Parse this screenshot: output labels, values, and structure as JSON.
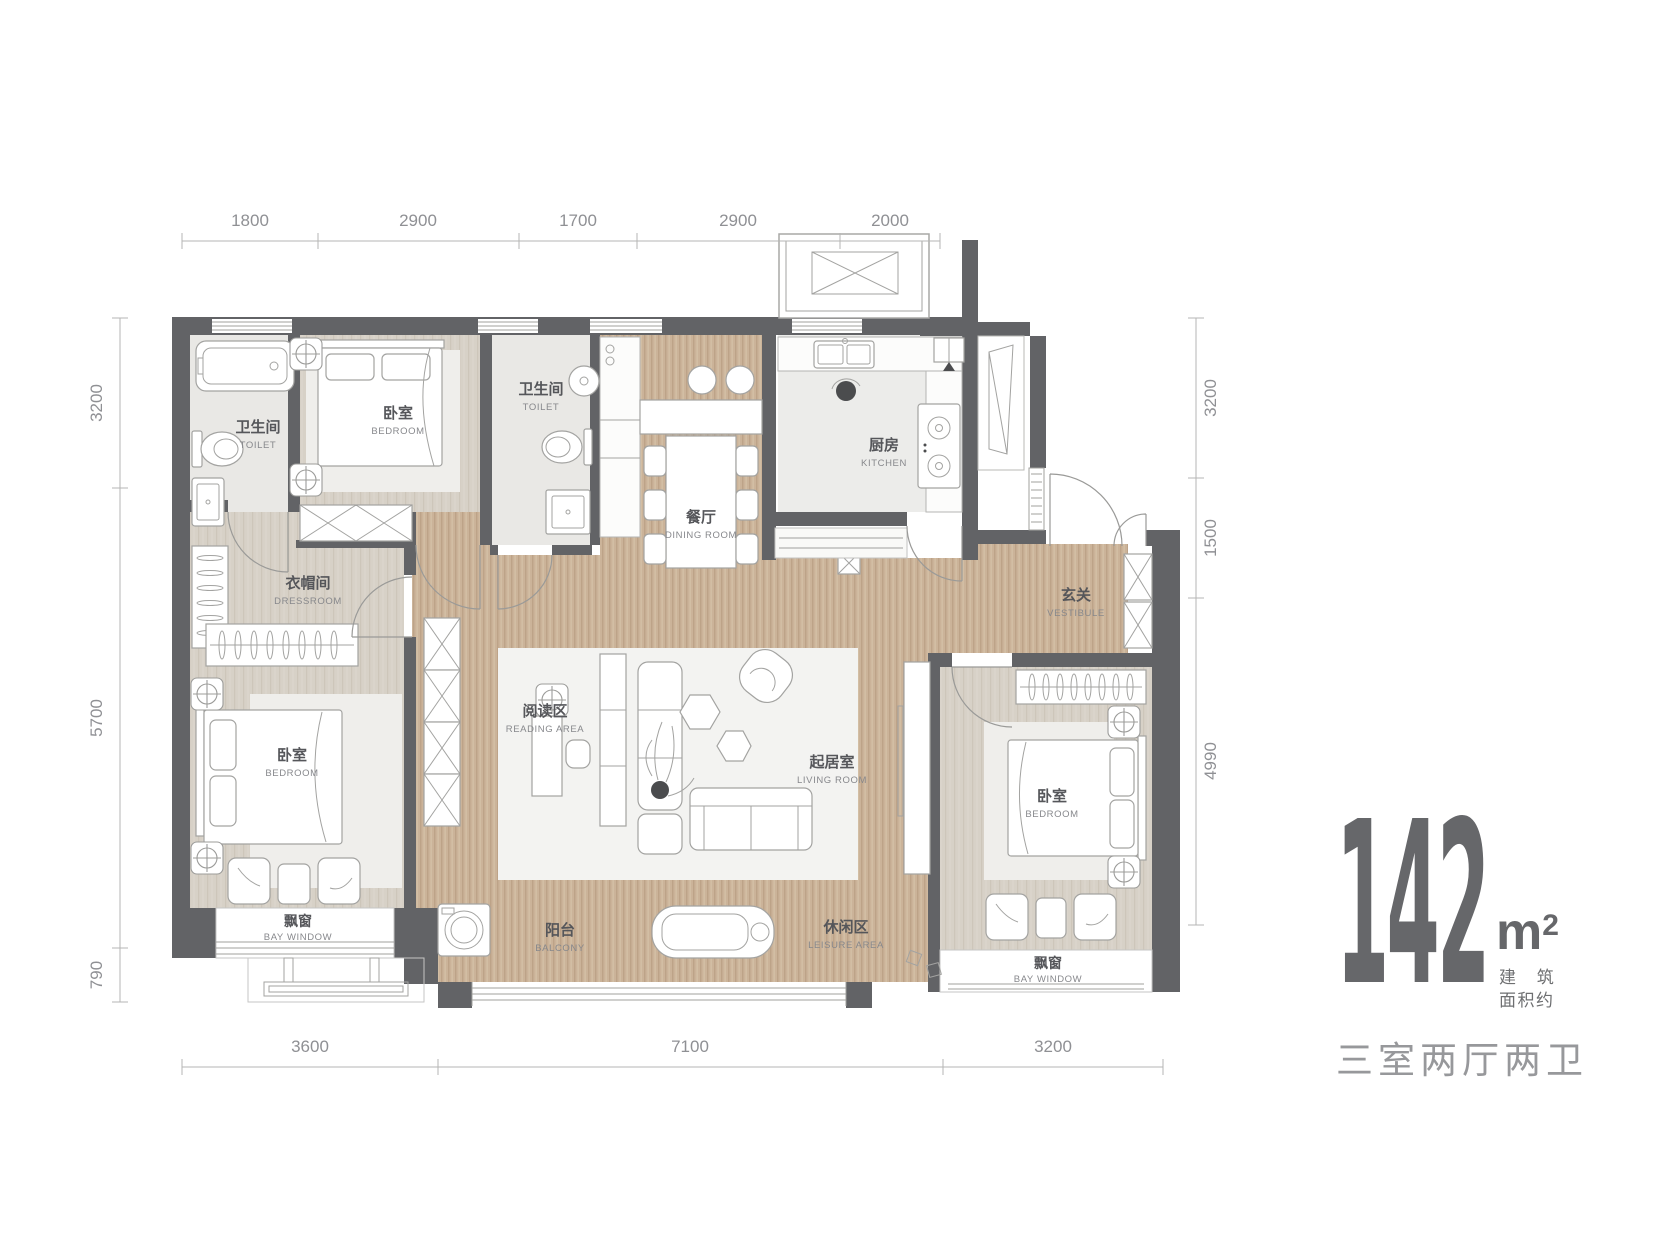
{
  "plan": {
    "dims": {
      "top": [
        "1800",
        "2900",
        "1700",
        "2900",
        "2000"
      ],
      "left": [
        "3200",
        "5700",
        "790"
      ],
      "right": [
        "3200",
        "1500",
        "4990"
      ],
      "bottom": [
        "3600",
        "7100",
        "3200"
      ]
    },
    "rooms": {
      "toilet_a": {
        "cn": "卫生间",
        "en": "TOILET"
      },
      "bedroom_top": {
        "cn": "卧室",
        "en": "BEDROOM"
      },
      "toilet_b": {
        "cn": "卫生间",
        "en": "TOILET"
      },
      "dining": {
        "cn": "餐厅",
        "en": "DINING ROOM"
      },
      "kitchen": {
        "cn": "厨房",
        "en": "KITCHEN"
      },
      "vestibule": {
        "cn": "玄关",
        "en": "VESTIBULE"
      },
      "dressroom": {
        "cn": "衣帽间",
        "en": "DRESSROOM"
      },
      "bedroom_left": {
        "cn": "卧室",
        "en": "BEDROOM"
      },
      "reading": {
        "cn": "阅读区",
        "en": "READING AREA"
      },
      "living": {
        "cn": "起居室",
        "en": "LIVING ROOM"
      },
      "bedroom_right": {
        "cn": "卧室",
        "en": "BEDROOM"
      },
      "bay_left": {
        "cn": "飘窗",
        "en": "BAY WINDOW"
      },
      "balcony": {
        "cn": "阳台",
        "en": "BALCONY"
      },
      "leisure": {
        "cn": "休闲区",
        "en": "LEISURE AREA"
      },
      "bay_right": {
        "cn": "飘窗",
        "en": "BAY WINDOW"
      }
    }
  },
  "branding": {
    "area_value": "142",
    "area_unit": "m",
    "area_sup": "2",
    "note_line1": "建 筑",
    "note_line2": "面积约",
    "layout_type": "三室两厅两卫"
  },
  "colors": {
    "wall": "#626366",
    "wood": "#cbb399",
    "floor_tile": "#e9e8e5",
    "floor_beige": "#d7d1c7",
    "brand_text": "#66676a",
    "label_text": "#55565a"
  }
}
